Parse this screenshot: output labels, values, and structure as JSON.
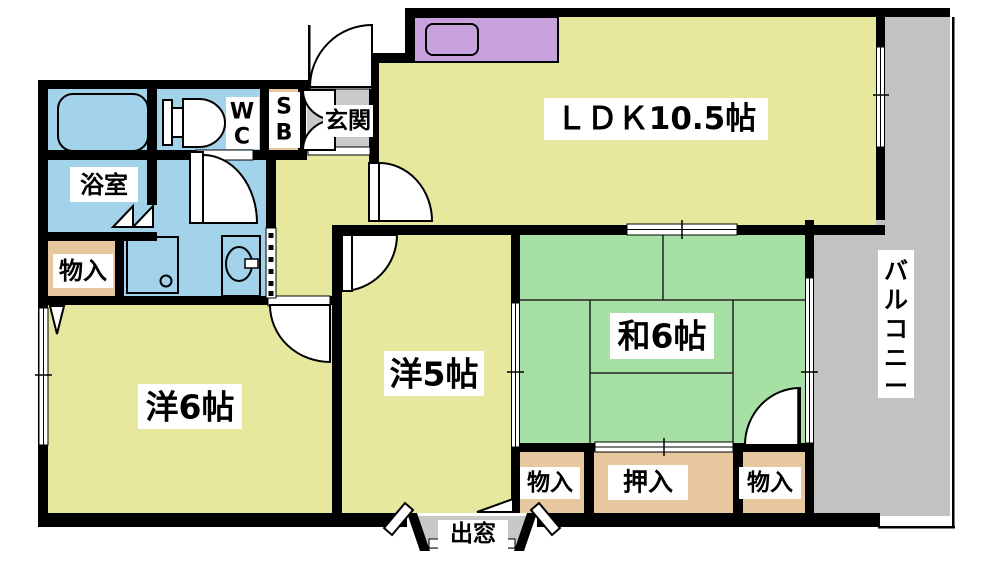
{
  "floorplan": {
    "rooms": {
      "ldk": {
        "label": "ＬＤＫ10.5帖"
      },
      "japanese_room": {
        "label": "和6帖"
      },
      "western_room_5": {
        "label": "洋5帖"
      },
      "western_room_6": {
        "label": "洋6帖"
      },
      "bathroom": {
        "label": "浴室"
      },
      "toilet": {
        "line1": "W",
        "line2": "C"
      },
      "shoe_box": {
        "line1": "S",
        "line2": "B"
      },
      "entrance": {
        "label": "玄関"
      },
      "balcony": {
        "label": "バルコニー",
        "chars": [
          "バ",
          "ル",
          "コ",
          "ニ",
          "ー"
        ]
      },
      "bay_window": {
        "label": "出窓"
      },
      "storage_top_left": {
        "label": "物入"
      },
      "storage_bottom_left": {
        "label": "物入"
      },
      "closet_oshiire": {
        "label": "押入"
      },
      "storage_bottom_right": {
        "label": "物入"
      }
    },
    "colors": {
      "room_yellow": "#E5E89D",
      "tatami_green": "#A7E0A4",
      "water_blue": "#A3D3EA",
      "closet_tan": "#E6C79E",
      "kitchen_purple": "#C8A2DC",
      "entry_gray": "#C9C9C9",
      "balcony_gray": "#C2C2C2",
      "bay_gray": "#C8C8C8",
      "wall": "#000000"
    }
  }
}
